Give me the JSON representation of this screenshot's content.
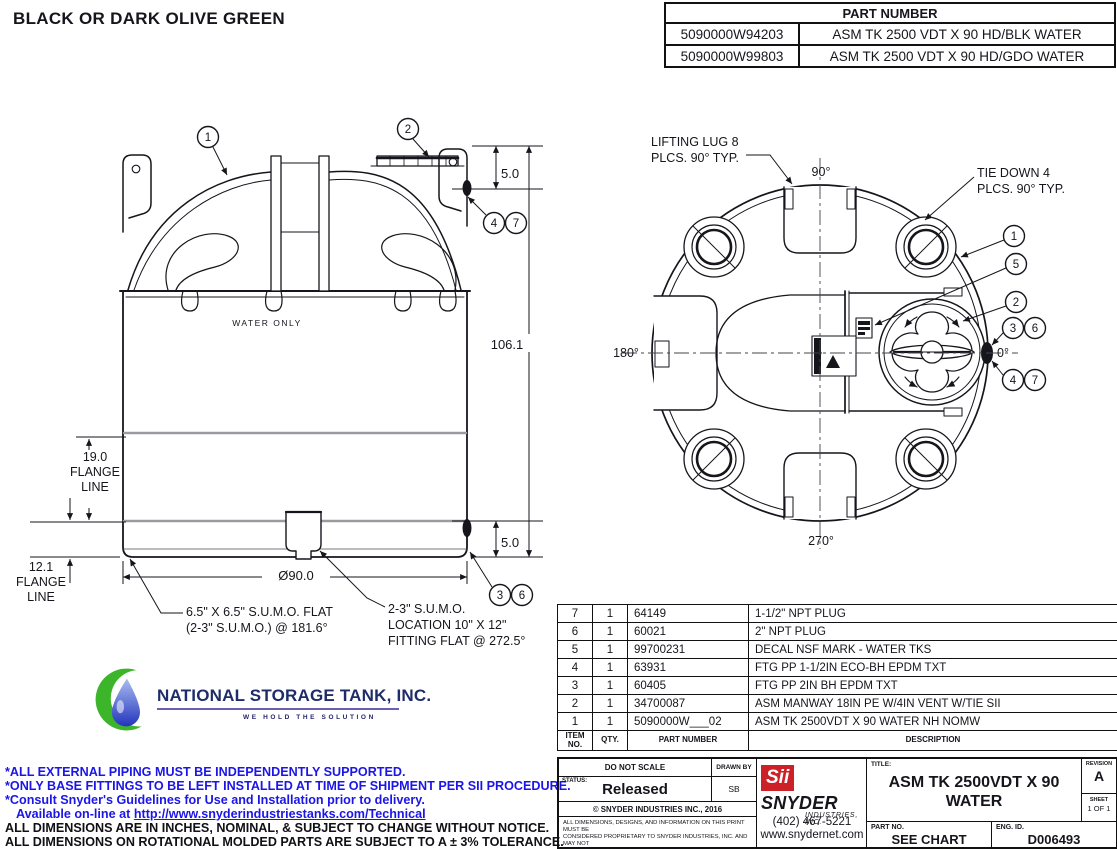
{
  "colors": {
    "accent_blue": "#1b15e8",
    "line": "#15151c",
    "logo_red": "#cc2127",
    "nst_navy": "#1e2d69",
    "nst_green": "#3db52a"
  },
  "header": {
    "color_note": "BLACK OR DARK OLIVE GREEN"
  },
  "part_table": {
    "title": "PART NUMBER",
    "rows": [
      {
        "pn": "5090000W94203",
        "desc": "ASM TK 2500 VDT X 90 HD/BLK WATER"
      },
      {
        "pn": "5090000W99803",
        "desc": "ASM TK 2500 VDT X 90 HD/GDO WATER"
      }
    ]
  },
  "side_view": {
    "water_label": "WATER ONLY",
    "dim_height": "106.1",
    "dim_top_fitting": "5.0",
    "dim_bottom_fitting": "5.0",
    "dim_diameter": "Ø90.0",
    "flange19": {
      "l1": "19.0",
      "l2": "FLANGE",
      "l3": "LINE"
    },
    "flange12": {
      "l1": "12.1",
      "l2": "FLANGE",
      "l3": "LINE"
    },
    "note_sumo_flat": {
      "l1": "6.5\" X 6.5\" S.U.M.O. FLAT",
      "l2": "(2-3\" S.U.M.O.) @ 181.6°"
    },
    "note_sumo_loc": {
      "l1": "2-3\" S.U.M.O.",
      "l2": "LOCATION 10\" X 12\"",
      "l3": "FITTING FLAT @ 272.5°"
    },
    "balloons": {
      "b1": "1",
      "b2": "2",
      "b3": "3",
      "b4": "4",
      "b6": "6",
      "b7": "7"
    }
  },
  "top_view": {
    "label_lifting_lug": {
      "l1": "LIFTING LUG 8",
      "l2": "PLCS. 90° TYP."
    },
    "label_tie_down": {
      "l1": "TIE DOWN 4",
      "l2": "PLCS. 90° TYP."
    },
    "angle_90": "90°",
    "angle_180": "180°",
    "angle_0": "0°",
    "angle_270": "270°",
    "balloons": {
      "b1": "1",
      "b2": "2",
      "b3": "3",
      "b4": "4",
      "b5": "5",
      "b6": "6",
      "b7": "7"
    }
  },
  "nst_logo": {
    "name": "NATIONAL STORAGE TANK, INC.",
    "tagline": "WE HOLD THE SOLUTION"
  },
  "notes": {
    "blue1": "*ALL EXTERNAL PIPING MUST BE INDEPENDENTLY SUPPORTED.",
    "blue2": "*ONLY BASE FITTINGS TO BE LEFT INSTALLED AT TIME OF SHIPMENT PER SII PROCEDURE.",
    "blue3": "*Consult Snyder's Guidelines for Use and Installation prior to delivery.",
    "link_prefix": "Available on-line at ",
    "link": "http://www.snyderindustriestanks.com/Technical",
    "black1": "ALL DIMENSIONS ARE IN INCHES, NOMINAL, & SUBJECT TO CHANGE WITHOUT NOTICE.",
    "black2": "ALL DIMENSIONS ON ROTATIONAL MOLDED PARTS ARE SUBJECT TO A ± 3% TOLERANCE."
  },
  "bom": {
    "col_item_l1": "ITEM",
    "col_item_l2": "NO.",
    "col_qty": "QTY.",
    "col_pn": "PART NUMBER",
    "col_desc": "DESCRIPTION",
    "rows": [
      {
        "item": "7",
        "qty": "1",
        "pn": "64149",
        "desc": "1-1/2\" NPT PLUG"
      },
      {
        "item": "6",
        "qty": "1",
        "pn": "60021",
        "desc": "2\" NPT PLUG"
      },
      {
        "item": "5",
        "qty": "1",
        "pn": "99700231",
        "desc": "DECAL NSF MARK - WATER TKS"
      },
      {
        "item": "4",
        "qty": "1",
        "pn": "63931",
        "desc": "FTG PP 1-1/2IN ECO-BH EPDM TXT"
      },
      {
        "item": "3",
        "qty": "1",
        "pn": "60405",
        "desc": "FTG PP 2IN BH EPDM TXT"
      },
      {
        "item": "2",
        "qty": "1",
        "pn": "34700087",
        "desc": "ASM MANWAY 18IN PE W/4IN VENT W/TIE SII"
      },
      {
        "item": "1",
        "qty": "1",
        "pn": "5090000W___02",
        "desc": "ASM TK 2500VDT X 90 WATER NH NOMW"
      }
    ]
  },
  "title_block": {
    "do_not_scale": "DO NOT SCALE",
    "status_label": "STATUS:",
    "status_value": "Released",
    "drawn_by_label": "DRAWN BY",
    "drawn_by_value": "SB",
    "copyright": "© SNYDER INDUSTRIES INC., 2016",
    "disclaimer1": "ALL DIMENSIONS, DESIGNS, AND INFORMATION ON THIS PRINT MUST BE",
    "disclaimer2": "CONSIDERED PROPRIETARY TO SNYDER INDUSTRIES, INC. AND MAY NOT",
    "disclaimer3": "BE USED, COPIED, OR DISTRIBUTED WITHOUT WRITTEN PERMISSION OF AN",
    "disclaimer4": "OFFICER (OR HIS AGENT) OF THE FIRM.",
    "logo_sii": "Sii",
    "logo_snyder": "SNYDER",
    "logo_industries": "INDUSTRIES, INC.",
    "phone": "(402) 467-5221",
    "website": "www.snydernet.com",
    "title_label": "TITLE:",
    "title_line1": "ASM TK 2500VDT X 90",
    "title_line2": "WATER",
    "revision_label": "REVISION",
    "revision": "A",
    "sheet_label": "SHEET",
    "sheet": "1 OF 1",
    "part_no_label": "PART NO.",
    "part_no": "SEE CHART",
    "eng_id_label": "ENG. ID.",
    "eng_id": "D006493"
  }
}
